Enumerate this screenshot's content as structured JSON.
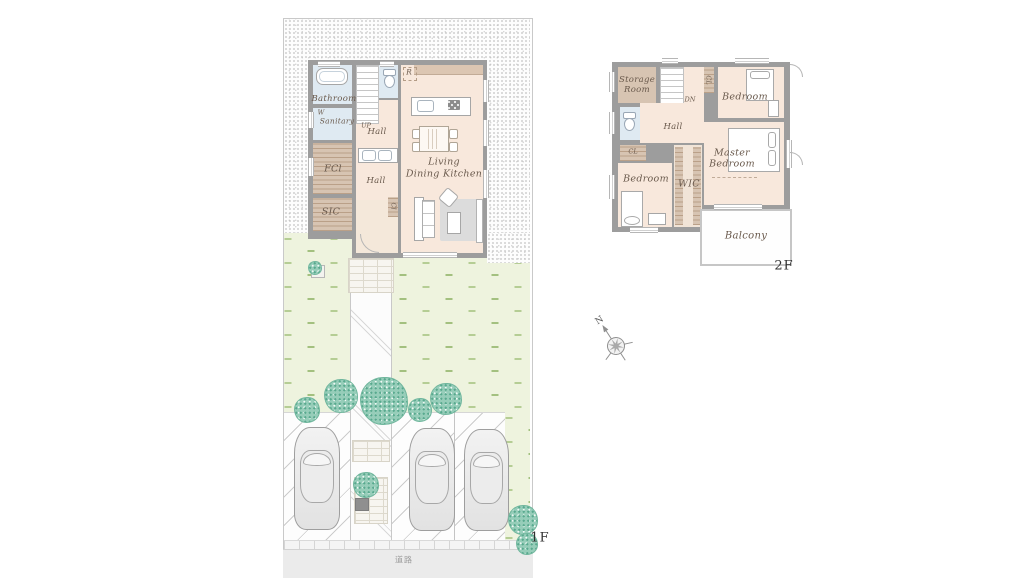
{
  "palette": {
    "wall": "#9d9d9d",
    "floor": "#f8e8dc",
    "water": "#dfeaf2",
    "closet": "#d7c4b2",
    "lawn": "#eef3de",
    "tree": "#8fcab6",
    "road": "#ebebeb",
    "label_brown": "#6a5a4d"
  },
  "floor1": {
    "floor_label": "1F",
    "road_label": "道路",
    "rooms": {
      "bathroom": "Bathroom",
      "washer": "W",
      "sanitary": "Sanitary",
      "stairs_up": "UP",
      "hall_upper": "Hall",
      "hall_lower": "Hall",
      "family_closet": "FCl",
      "shoe_closet": "SIC",
      "entry_closet": "Cl",
      "fridge": "R",
      "ldk_line1": "Living",
      "ldk_line2": "Dining Kitchen"
    }
  },
  "floor2": {
    "floor_label": "2F",
    "rooms": {
      "storage_line1": "Storage",
      "storage_line2": "Room",
      "stairs_down": "DN",
      "closet_top": "CL",
      "closet_left": "CL",
      "bedroom_right": "Bedroom",
      "bedroom_left": "Bedroom",
      "hall": "Hall",
      "wic": "WIC",
      "master_line1": "Master",
      "master_line2": "Bedroom",
      "balcony": "Balcony"
    }
  },
  "compass": {
    "north": "N"
  }
}
